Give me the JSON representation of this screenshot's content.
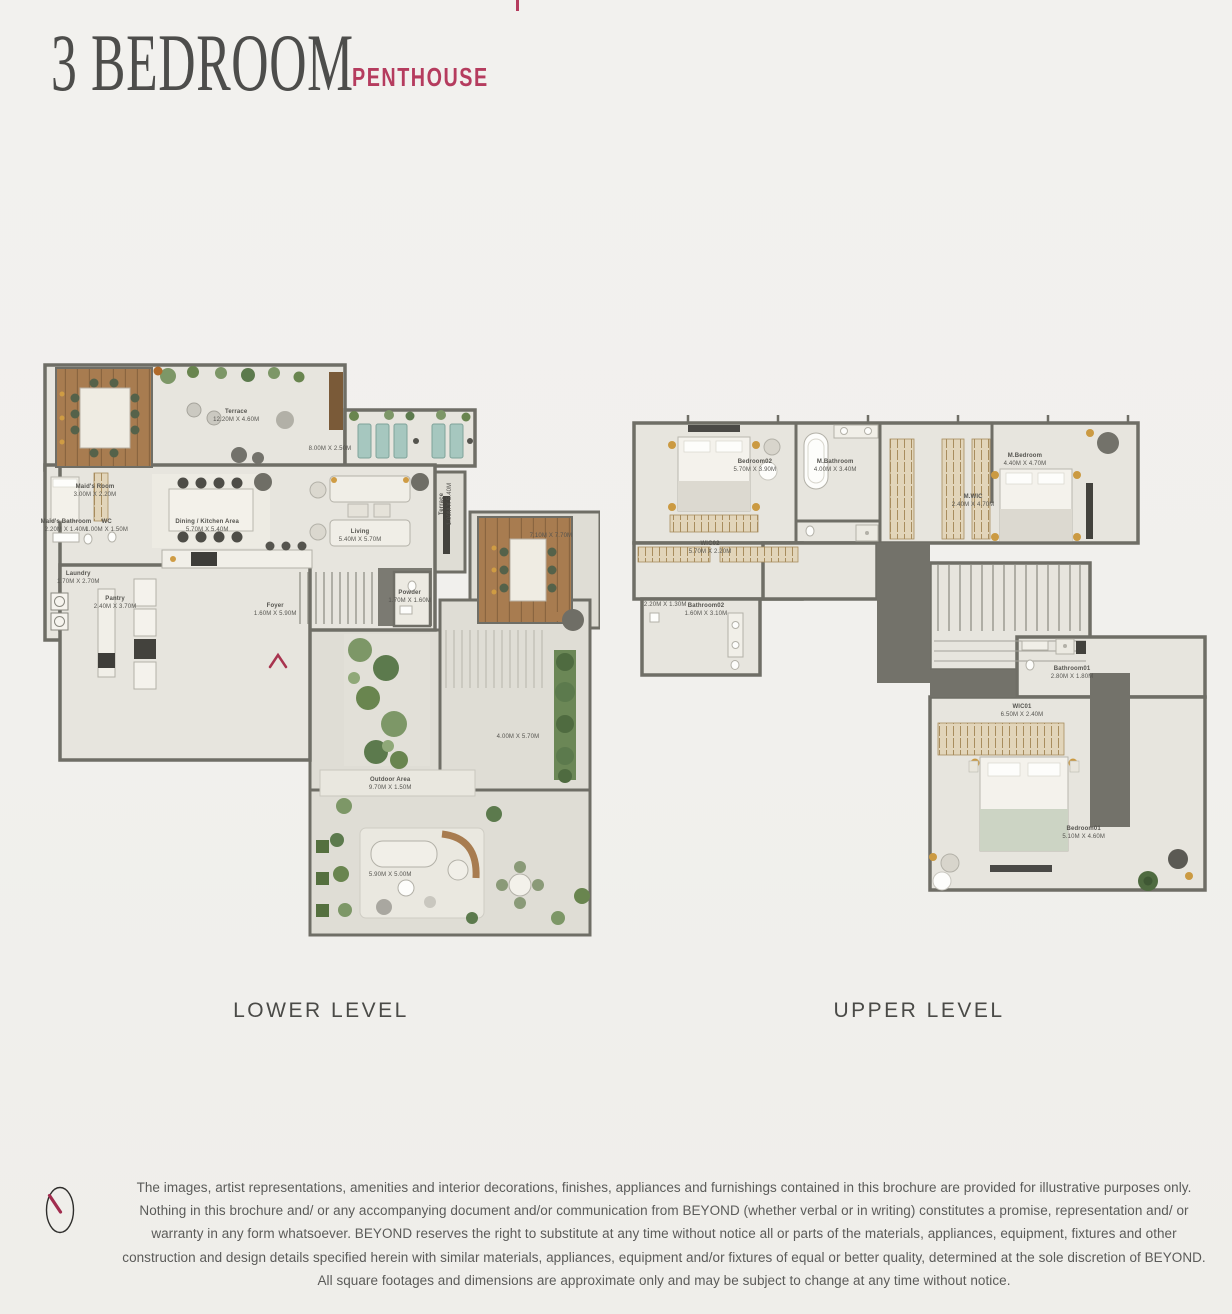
{
  "page": {
    "title": "3 BEDROOM",
    "subtitle": "PENTHOUSE"
  },
  "palette": {
    "accent": "#b53c5e",
    "title_text": "#4d4d4b",
    "caption_text": "#4a4a47",
    "label_text": "#55544f",
    "body_text": "#5b5b59",
    "wall": "#6f6e66",
    "floor_indoor": "#e7e5de",
    "floor_outdoor": "#dfddd5",
    "wood_deck": "#a87c50",
    "plant_green": "#7d9767",
    "entrance_arrow": "#a8344f"
  },
  "plans": [
    {
      "id": "lower",
      "caption": "LOWER LEVEL",
      "labels": [
        {
          "name": "Terrace",
          "dims": "12.20M X 4.60M",
          "x": 34.8,
          "y": 9.4
        },
        {
          "name": "",
          "dims": "8.00M X 2.50M",
          "x": 51.6,
          "y": 15.1
        },
        {
          "name": "Maid's Room",
          "dims": "3.00M X 2.20M",
          "x": 9.5,
          "y": 22.4
        },
        {
          "name": "Maid's Bathroom",
          "dims": "2.20M X 1.40M",
          "x": 4.3,
          "y": 28.5
        },
        {
          "name": "WC",
          "dims": "1.00M X 1.50M",
          "x": 11.6,
          "y": 28.5
        },
        {
          "name": "Dining / Kitchen Area",
          "dims": "5.70M X 5.40M",
          "x": 29.6,
          "y": 28.5
        },
        {
          "name": "Living",
          "dims": "5.40M X 5.70M",
          "x": 57.0,
          "y": 30.3
        },
        {
          "name": "Terrace",
          "dims": "1.00M X 5.40M",
          "x": 72.4,
          "y": 24.7,
          "rot": 90
        },
        {
          "name": "",
          "dims": "7.10M X 7.70M",
          "x": 91.2,
          "y": 30.3
        },
        {
          "name": "Laundry",
          "dims": "1.70M X 2.70M",
          "x": 6.5,
          "y": 37.5
        },
        {
          "name": "Pantry",
          "dims": "2.40M X 3.70M",
          "x": 13.1,
          "y": 41.9
        },
        {
          "name": "Foyer",
          "dims": "1.60M X 5.90M",
          "x": 41.8,
          "y": 43.1
        },
        {
          "name": "Powder",
          "dims": "1.70M X 1.60M",
          "x": 65.9,
          "y": 40.9
        },
        {
          "name": "Outdoor Area",
          "dims": "9.70M X 1.50M",
          "x": 62.4,
          "y": 73.4
        },
        {
          "name": "",
          "dims": "4.00M X 5.70M",
          "x": 85.3,
          "y": 65.2
        },
        {
          "name": "",
          "dims": "5.90M X 5.00M",
          "x": 62.4,
          "y": 89.2
        }
      ]
    },
    {
      "id": "upper",
      "caption": "UPPER LEVEL",
      "labels": [
        {
          "name": "Bedroom02",
          "dims": "5.70M X 3.90M",
          "x": 21.8,
          "y": 10.8
        },
        {
          "name": "M.Bathroom",
          "dims": "4.00M X 3.40M",
          "x": 35.6,
          "y": 10.8
        },
        {
          "name": "M.WIC",
          "dims": "2.40M X 4.70M",
          "x": 59.3,
          "y": 17.9
        },
        {
          "name": "M.Bedroom",
          "dims": "4.40M X 4.70M",
          "x": 68.2,
          "y": 9.5
        },
        {
          "name": "WIC02",
          "dims": "5.70M X 2.20M",
          "x": 14.1,
          "y": 27.5
        },
        {
          "name": "",
          "dims": "2.20M X 1.30M",
          "x": 6.4,
          "y": 39.0
        },
        {
          "name": "Bathroom02",
          "dims": "1.60M X 3.10M",
          "x": 13.4,
          "y": 40.0
        },
        {
          "name": "Bathroom01",
          "dims": "2.80M X 1.80M",
          "x": 76.3,
          "y": 52.8
        },
        {
          "name": "WIC01",
          "dims": "6.50M X 2.40M",
          "x": 67.7,
          "y": 60.6
        },
        {
          "name": "Bedroom01",
          "dims": "5.10M X 4.60M",
          "x": 78.3,
          "y": 85.4
        }
      ]
    }
  ],
  "footer": {
    "disclaimer": "The images, artist representations, amenities and interior decorations, finishes, appliances and furnishings contained in this brochure are provided for illustrative purposes only. Nothing in this brochure and/ or any accompanying document and/or communication from BEYOND (whether verbal or in writing) constitutes a promise, representation and/ or warranty in any form whatsoever. BEYOND reserves the right to substitute at any time without notice all or parts of the materials, appliances, equipment, fixtures and other construction and design details specified herein with similar materials, appliances, equipment and/or fixtures of equal or better quality, determined at the sole discretion of BEYOND. All square footages and dimensions are approximate only and may be subject to change at any time without notice."
  },
  "icons": {
    "logo": "brand-clock-logo",
    "entrance": "entrance-arrow"
  }
}
